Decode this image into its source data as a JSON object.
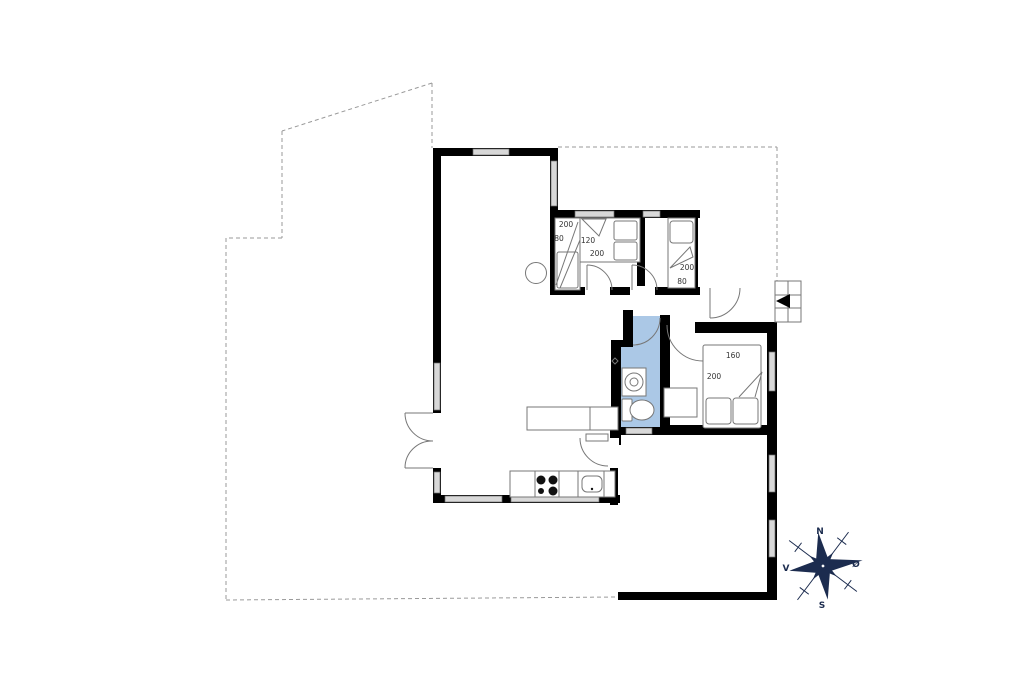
{
  "plan": {
    "bedroom_left": {
      "bunk_length": "200",
      "bunk_width": "80",
      "bed_width": "120",
      "bed_length": "200"
    },
    "bedroom_right": {
      "bed_length": "200",
      "bed_width": "80"
    },
    "bedroom_master": {
      "bed_width": "160",
      "bed_length": "200"
    },
    "compass": {
      "n": "N",
      "s": "S",
      "w": "V",
      "e": "Ø"
    }
  },
  "colors": {
    "wall": "#000000",
    "window_fill": "#d8d8d8",
    "window_stroke": "#6b6b6b",
    "bathroom": "#abc8e6",
    "line": "#777777",
    "dashed": "#9a9a9a",
    "compass": "#1c2c4f",
    "label": "#333333"
  }
}
